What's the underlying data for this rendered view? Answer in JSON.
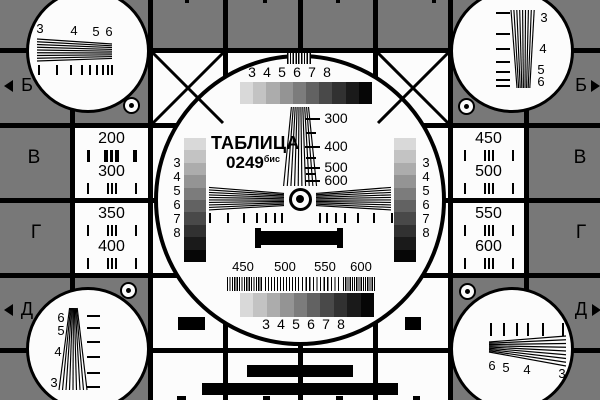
{
  "card": {
    "title": "ТАБЛИЦА",
    "number": "0249",
    "number_suffix": "бис"
  },
  "colors": {
    "background_gray": "#787878",
    "card_white": "#fcfcfc",
    "line_black": "#000000",
    "grayscale_steps": [
      "#d9d9d9",
      "#c3c3c3",
      "#acacac",
      "#949494",
      "#7c7c7c",
      "#626262",
      "#494949",
      "#313131",
      "#1a1a1a",
      "#060606"
    ]
  },
  "center_circle": {
    "top_scale_labels": [
      "3",
      "4",
      "5",
      "6",
      "7",
      "8"
    ],
    "frequency_labels": [
      "300",
      "400",
      "500",
      "600"
    ],
    "left_scale_labels": [
      "3",
      "4",
      "5",
      "6",
      "7",
      "8"
    ],
    "right_scale_labels": [
      "3",
      "4",
      "5",
      "6",
      "7",
      "8"
    ],
    "burst_frequency_labels": [
      "450",
      "500",
      "550",
      "600"
    ],
    "bottom_scale_labels": [
      "3",
      "4",
      "5",
      "6",
      "7",
      "8"
    ]
  },
  "corner_circles": {
    "top_left_labels": [
      "3",
      "4",
      "5",
      "6"
    ],
    "top_right_labels": [
      "3",
      "4",
      "5",
      "6"
    ],
    "bottom_left_labels": [
      "6",
      "5",
      "4",
      "3"
    ],
    "bottom_right_labels": [
      "6",
      "5",
      "4",
      "3"
    ]
  },
  "row_markers": {
    "left": [
      "Б",
      "В",
      "Г",
      "Д"
    ],
    "right": [
      "Б",
      "В",
      "Г",
      "Д"
    ]
  },
  "resolution_cells": {
    "left_upper": [
      "200",
      "300"
    ],
    "left_lower": [
      "350",
      "400"
    ],
    "right_upper": [
      "450",
      "500"
    ],
    "right_lower": [
      "550",
      "600"
    ]
  }
}
